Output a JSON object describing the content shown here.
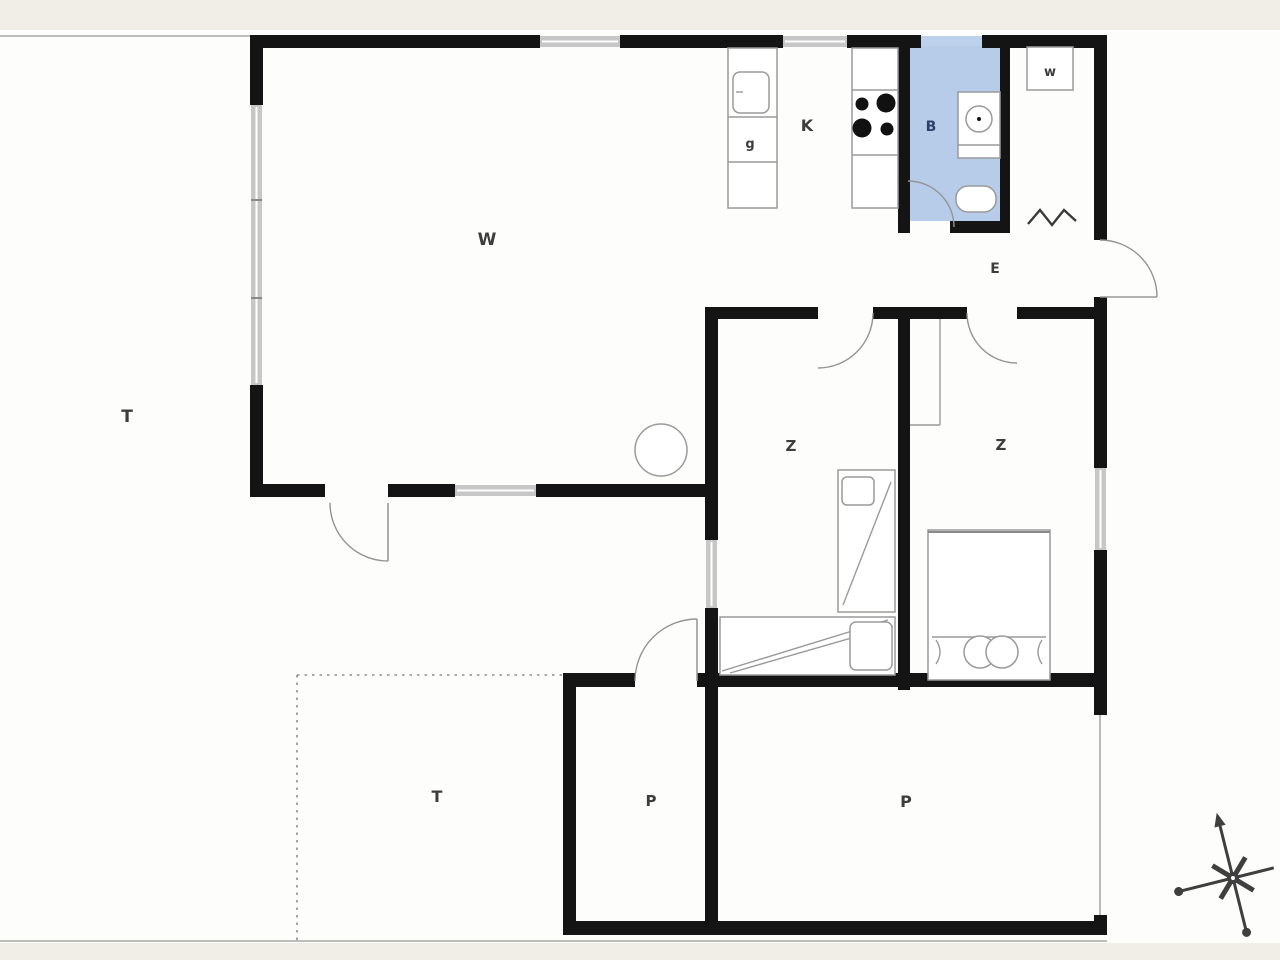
{
  "title": "Summer house floor plan",
  "colors": {
    "wall": "#141414",
    "window": "#c7c7c7",
    "bathroom_fill": "#b7cce9",
    "bathroom_window": "#bdd1ec",
    "outline": "#9a9a9a",
    "label": "#3d3d3d",
    "bathroom_label": "#2e3f6e",
    "background": "#f1eee7",
    "paper": "#fdfdfc"
  },
  "labels": {
    "terrace_left": "T",
    "living_room": "W",
    "kitchen": "K",
    "kitchen_cabinet": "g",
    "bathroom": "B",
    "wardrobe": "w",
    "entrance": "E",
    "bedroom_left": "Z",
    "bedroom_right": "Z",
    "terrace_south": "T",
    "storage_left": "P",
    "storage_right": "P"
  }
}
